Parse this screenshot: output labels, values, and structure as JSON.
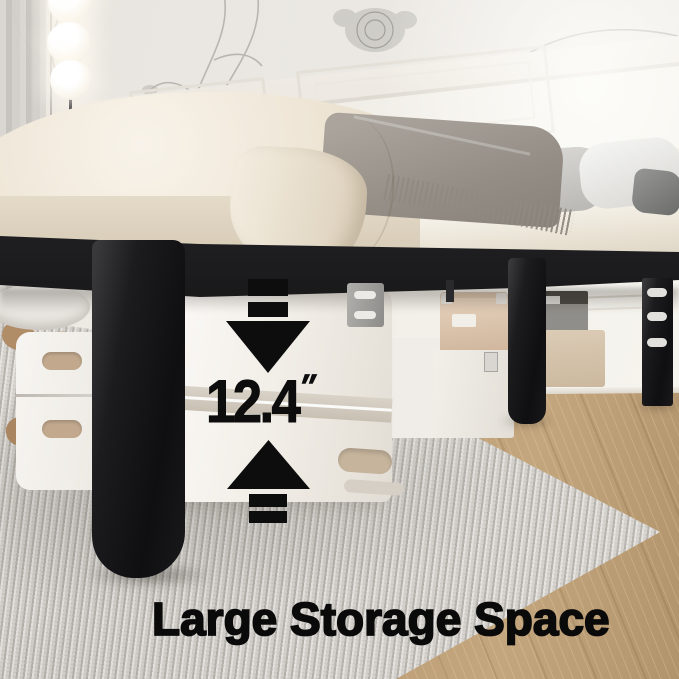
{
  "annotation": {
    "measurement": {
      "value": "12.4",
      "unit": "″"
    },
    "caption": "Large Storage Space"
  },
  "icons": {
    "down_arrow": "down-arrow-icon",
    "up_arrow": "up-arrow-icon"
  },
  "scene_objects": [
    "floor-lamp",
    "window-curtain",
    "floral-wallpaper",
    "wainscot-wall",
    "mattress-with-sheets",
    "throw-blanket",
    "pillows",
    "black-metal-bed-frame",
    "bed-legs",
    "suitcases",
    "leather-storage-box",
    "storage-trunk",
    "gray-storage-box",
    "storage-bench",
    "area-rug",
    "wood-floor"
  ],
  "colors": {
    "annotation_black": "#0d0d0d",
    "bed_frame_black": "#18181a",
    "mattress_cream": "#ece2d1",
    "blanket_gray": "#948e86",
    "accent_tan": "#c9b196",
    "wood_floor_tan": "#c0a177",
    "rug_gray": "#d7d4cf",
    "wall_cream": "#efece6",
    "lamp_glow_white": "#fdf9f1"
  }
}
